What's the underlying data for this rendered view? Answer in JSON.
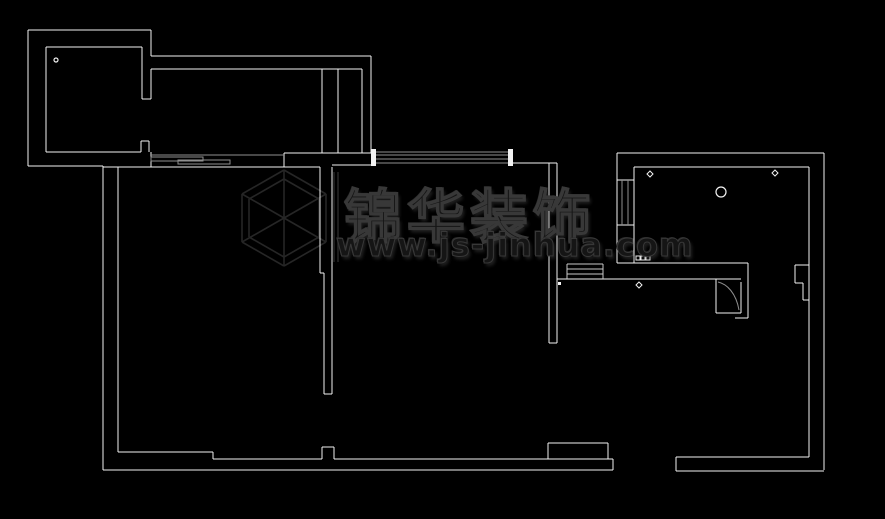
{
  "canvas": {
    "width": 885,
    "height": 519,
    "background": "#000000"
  },
  "palette": {
    "wall": "#f2f2f2",
    "detail_gray": "#8f8f8f",
    "detail_light": "#c9c9c9",
    "watermark": "#262626"
  },
  "watermark": {
    "brand_text": "锦华装饰",
    "url_text": "www.js-jinhua.com"
  },
  "floorplan": {
    "walls": [
      [
        28,
        30,
        151,
        30
      ],
      [
        28,
        30,
        28,
        166
      ],
      [
        28,
        166,
        103,
        166
      ],
      [
        46,
        47,
        142,
        47
      ],
      [
        46,
        47,
        46,
        152
      ],
      [
        46,
        152,
        141,
        152
      ],
      [
        151,
        30,
        151,
        56
      ],
      [
        142,
        47,
        142,
        99
      ],
      [
        151,
        69,
        151,
        99
      ],
      [
        142,
        99,
        151,
        99
      ],
      [
        141,
        141,
        149,
        141
      ],
      [
        141,
        141,
        141,
        152
      ],
      [
        149,
        141,
        149,
        152
      ],
      [
        151,
        152,
        151,
        167
      ],
      [
        151,
        56,
        371,
        56
      ],
      [
        151,
        69,
        362,
        69
      ],
      [
        371,
        56,
        371,
        153
      ],
      [
        322,
        69,
        322,
        153
      ],
      [
        338,
        69,
        338,
        153
      ],
      [
        362,
        69,
        362,
        153
      ],
      [
        284,
        153,
        372,
        153
      ],
      [
        284,
        153,
        284,
        167
      ],
      [
        103,
        167,
        320,
        167
      ],
      [
        332,
        165,
        371,
        165
      ],
      [
        320,
        167,
        320,
        273
      ],
      [
        320,
        273,
        324,
        273
      ],
      [
        324,
        273,
        324,
        394
      ],
      [
        332,
        167,
        332,
        394
      ],
      [
        324,
        394,
        332,
        394
      ],
      [
        512,
        163,
        549,
        163
      ],
      [
        549,
        163,
        549,
        343
      ],
      [
        557,
        163,
        557,
        343
      ],
      [
        549,
        163,
        557,
        163
      ],
      [
        549,
        343,
        557,
        343
      ],
      [
        617,
        153,
        617,
        263
      ],
      [
        634,
        167,
        634,
        263
      ],
      [
        617,
        263,
        748,
        263
      ],
      [
        557,
        279,
        741,
        279
      ],
      [
        617,
        153,
        824,
        153
      ],
      [
        634,
        167,
        809,
        167
      ],
      [
        824,
        153,
        824,
        470
      ],
      [
        809,
        167,
        809,
        457
      ],
      [
        617,
        180,
        634,
        180
      ],
      [
        617,
        225,
        634,
        225
      ],
      [
        795,
        265,
        809,
        265
      ],
      [
        795,
        265,
        795,
        283
      ],
      [
        795,
        283,
        803,
        283
      ],
      [
        803,
        283,
        803,
        300
      ],
      [
        803,
        300,
        809,
        300
      ],
      [
        716,
        279,
        716,
        313
      ],
      [
        716,
        313,
        741,
        313
      ],
      [
        741,
        282,
        741,
        313
      ],
      [
        748,
        263,
        748,
        318
      ],
      [
        735,
        318,
        748,
        318
      ],
      [
        103,
        166,
        103,
        470
      ],
      [
        118,
        167,
        118,
        452
      ],
      [
        118,
        452,
        213,
        452
      ],
      [
        213,
        452,
        213,
        459
      ],
      [
        213,
        459,
        322,
        459
      ],
      [
        322,
        447,
        322,
        459
      ],
      [
        322,
        447,
        334,
        447
      ],
      [
        334,
        447,
        334,
        459
      ],
      [
        334,
        459,
        613,
        459
      ],
      [
        103,
        470,
        613,
        470
      ],
      [
        613,
        459,
        613,
        470
      ],
      [
        548,
        443,
        548,
        459
      ],
      [
        548,
        443,
        608,
        443
      ],
      [
        608,
        443,
        608,
        459
      ],
      [
        676,
        457,
        676,
        471
      ],
      [
        676,
        457,
        809,
        457
      ],
      [
        676,
        471,
        824,
        471
      ]
    ],
    "gray_lines": [
      [
        151,
        155,
        284,
        155
      ],
      [
        376,
        152,
        508,
        152
      ],
      [
        376,
        155,
        508,
        155
      ],
      [
        376,
        159,
        508,
        159
      ],
      [
        376,
        163,
        508,
        163
      ],
      [
        622,
        180,
        622,
        225
      ],
      [
        628,
        180,
        628,
        225
      ]
    ],
    "light_lines": [
      [
        567,
        264,
        603,
        264
      ],
      [
        567,
        269,
        603,
        269
      ],
      [
        567,
        274,
        603,
        274
      ],
      [
        567,
        264,
        567,
        279
      ],
      [
        603,
        264,
        603,
        279
      ]
    ],
    "gray_rects": [
      [
        151,
        157,
        52,
        4
      ],
      [
        178,
        160,
        52,
        4
      ]
    ],
    "white_rects": [
      [
        371,
        149,
        5,
        17
      ],
      [
        508,
        149,
        5,
        17
      ],
      [
        558,
        282,
        3,
        3
      ]
    ],
    "outline_rects": [
      [
        636,
        256,
        4,
        4
      ],
      [
        641,
        256,
        4,
        4
      ],
      [
        646,
        256,
        4,
        4
      ]
    ],
    "curves": [
      {
        "d": "M 718 282 C 727 284 736 293 739 310"
      }
    ],
    "markers": {
      "circles": [
        [
          56,
          60,
          2
        ],
        [
          721,
          192,
          5
        ]
      ],
      "diamonds": [
        [
          650,
          174,
          3
        ],
        [
          775,
          173,
          3
        ],
        [
          639,
          285,
          3
        ]
      ]
    },
    "watermark_lines": [
      [
        284,
        170,
        326,
        194
      ],
      [
        326,
        194,
        326,
        242
      ],
      [
        326,
        242,
        284,
        266
      ],
      [
        284,
        266,
        242,
        242
      ],
      [
        242,
        242,
        242,
        194
      ],
      [
        242,
        194,
        284,
        170
      ],
      [
        284,
        179,
        319,
        199
      ],
      [
        319,
        199,
        319,
        237
      ],
      [
        319,
        237,
        284,
        257
      ],
      [
        284,
        257,
        249,
        237
      ],
      [
        249,
        237,
        249,
        199
      ],
      [
        249,
        199,
        284,
        179
      ],
      [
        284,
        218,
        284,
        170
      ],
      [
        284,
        218,
        326,
        194
      ],
      [
        284,
        218,
        326,
        242
      ],
      [
        284,
        218,
        284,
        266
      ],
      [
        284,
        218,
        242,
        242
      ],
      [
        284,
        218,
        242,
        194
      ],
      [
        334,
        172,
        334,
        262
      ],
      [
        338,
        172,
        338,
        262
      ]
    ]
  }
}
